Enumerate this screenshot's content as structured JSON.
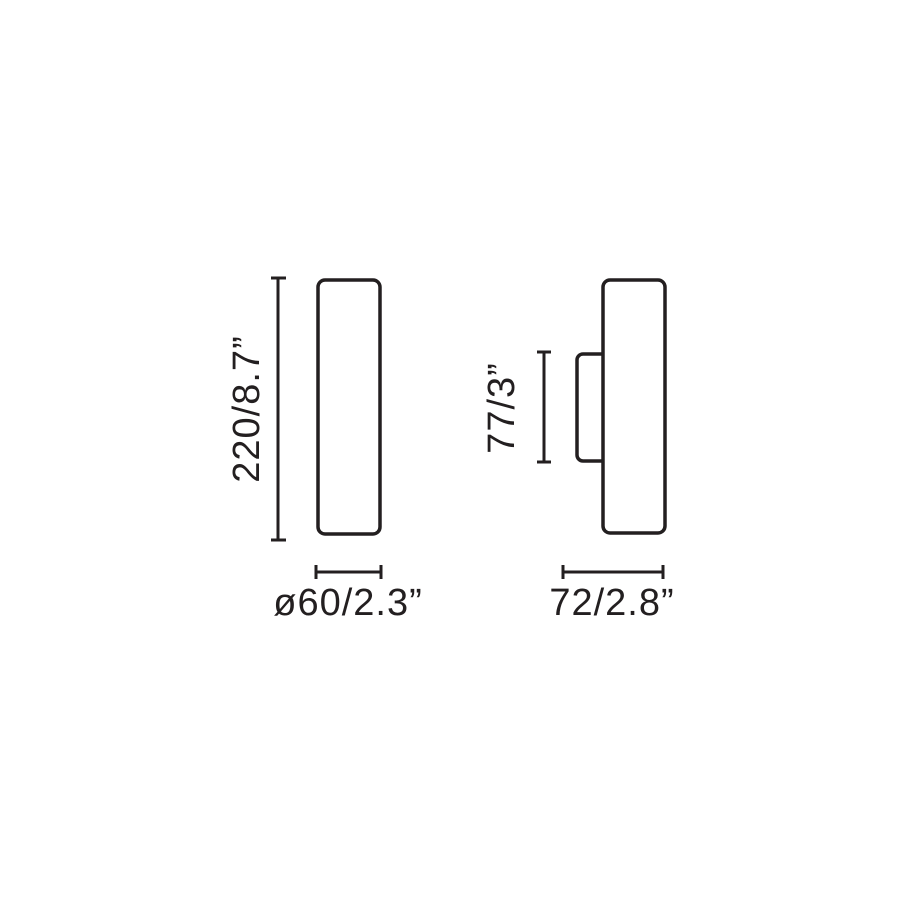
{
  "colors": {
    "line": "#231f20",
    "background": "#ffffff"
  },
  "front_view": {
    "height_label": "220/8.7”",
    "diameter_label": "ø60/2.3”"
  },
  "side_view": {
    "bracket_height_label": "77/3”",
    "depth_label": "72/2.8”"
  }
}
